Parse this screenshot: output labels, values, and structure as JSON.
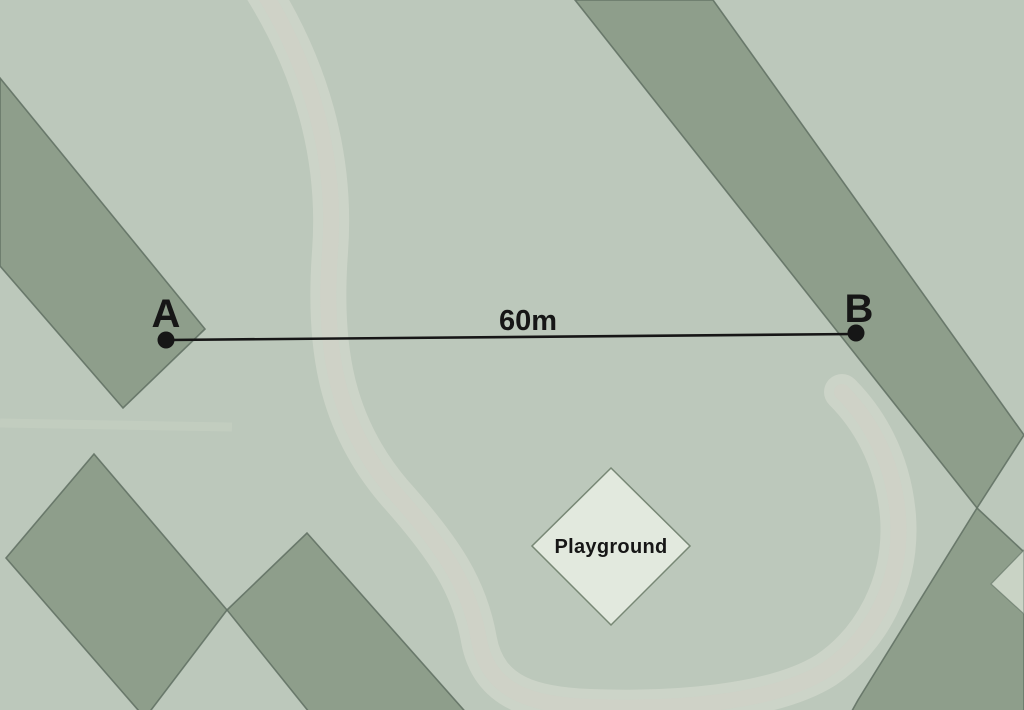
{
  "map": {
    "markers": {
      "a": "A",
      "b": "B"
    },
    "distance_label": "60m",
    "playground_label": "Playground",
    "colors": {
      "background": "#bcc8bb",
      "background_light": "#c9d3c5",
      "building": "#8e9e8b",
      "building_edge": "#5f6f62",
      "playground_fill": "#e2e9de",
      "playground_edge": "#6e7e6b",
      "path_light": "#d7dcd1",
      "path_tint": "#d6cdc5",
      "ink": "#161616"
    }
  }
}
